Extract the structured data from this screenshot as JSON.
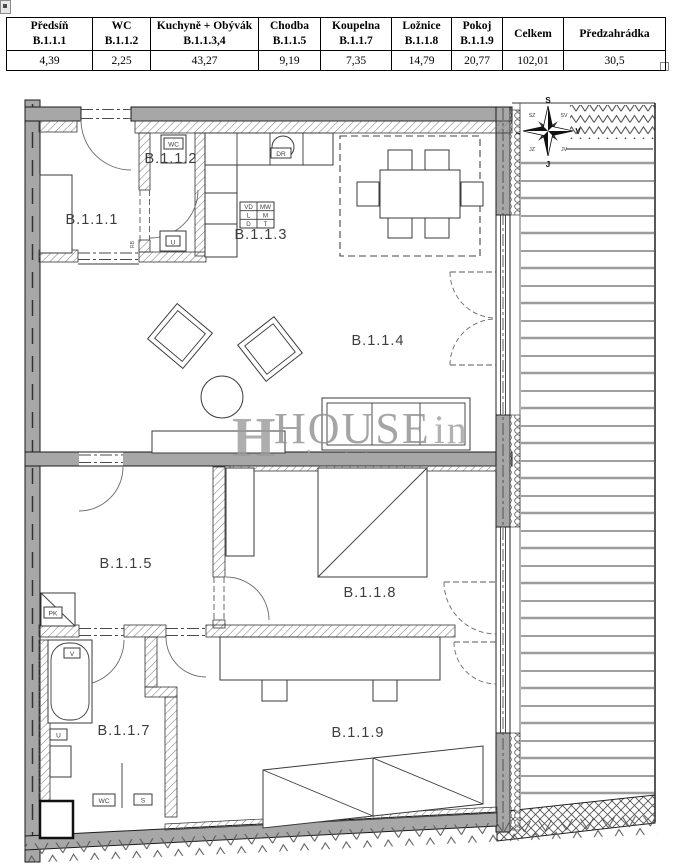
{
  "area_table": {
    "columns": [
      {
        "name": "Předsíň",
        "code": "B.1.1.1",
        "value": "4,39"
      },
      {
        "name": "WC",
        "code": "B.1.1.2",
        "value": "2,25"
      },
      {
        "name": "Kuchyně + Obývák",
        "code": "B.1.1.3,4",
        "value": "43,27"
      },
      {
        "name": "Chodba",
        "code": "B.1.1.5",
        "value": "9,19"
      },
      {
        "name": "Koupelna",
        "code": "B.1.1.7",
        "value": "7,35"
      },
      {
        "name": "Ložnice",
        "code": "B.1.1.8",
        "value": "14,79"
      },
      {
        "name": "Pokoj",
        "code": "B.1.1.9",
        "value": "20,77"
      },
      {
        "name": "Celkem",
        "code": "",
        "value": "102,01"
      },
      {
        "name": "Předzahrádka",
        "code": "",
        "value": "30,5"
      }
    ]
  },
  "floor_plan": {
    "rooms": {
      "r1": "B.1.1.1",
      "r2": "B.1.1.2",
      "r3": "B.1.1.3",
      "r4": "B.1.1.4",
      "r5": "B.1.1.5",
      "r7": "B.1.1.7",
      "r8": "B.1.1.8",
      "r9": "B.1.1.9"
    },
    "fixtures": {
      "wc_room_toilet": "WC",
      "wc_room_sink": "U",
      "kitchen_hob": "DR",
      "hall_shaft": "PK",
      "hall_rb": "RB",
      "bath_tub": "V",
      "bath_sink": "U",
      "bath_wc": "WC",
      "bath_s": "S"
    },
    "kitchen_legend": [
      [
        "VD",
        "MW"
      ],
      [
        "L",
        "M"
      ],
      [
        "D",
        "T"
      ]
    ],
    "compass": {
      "n": "S",
      "ne": "SV",
      "e": "V",
      "se": "JV",
      "s": "J",
      "sw": "JZ",
      "w": "Z",
      "nw": "SZ"
    },
    "watermark": {
      "mark": "H",
      "brand": "HOUSE",
      "suffix": "in",
      "tagline": "real estate"
    },
    "colors": {
      "wall": "#a7a7a7",
      "hatch_line": "#808080",
      "watermark": "#979797"
    }
  }
}
